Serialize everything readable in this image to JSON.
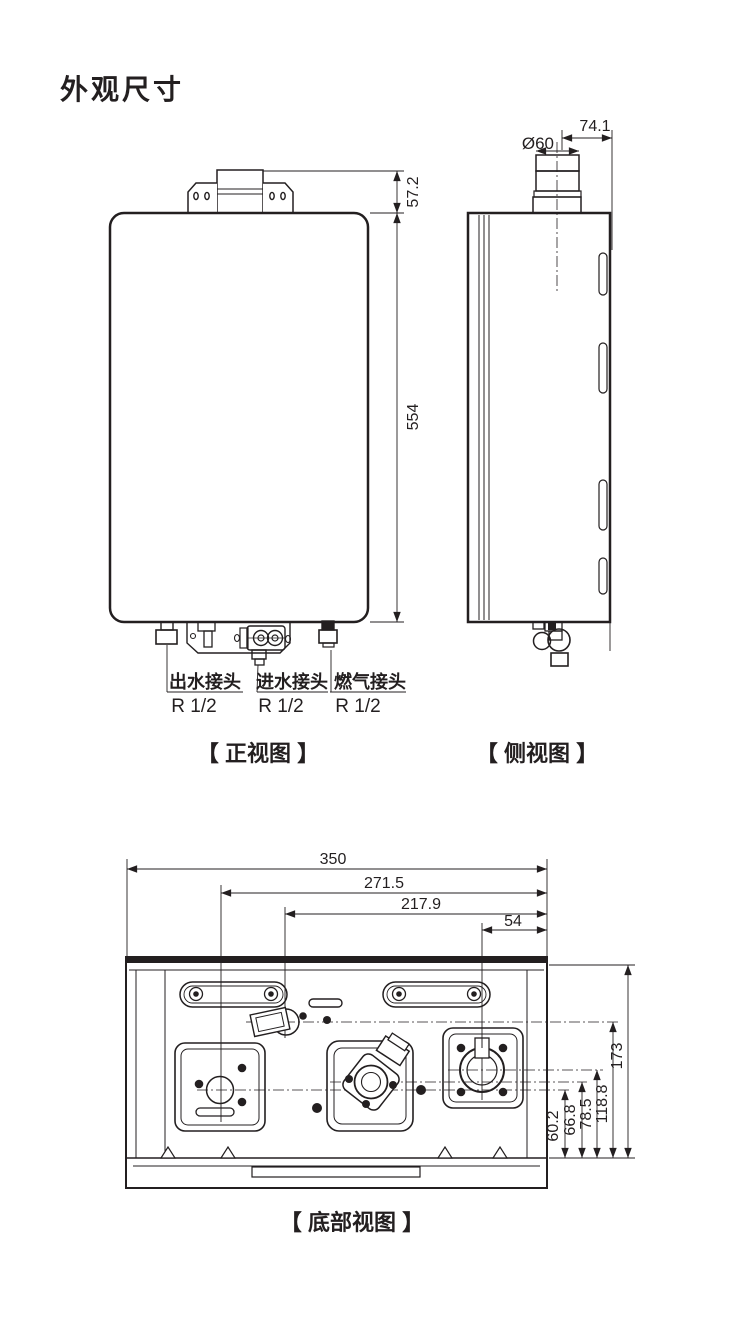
{
  "title": "外观尺寸",
  "colors": {
    "line": "#231f20",
    "background": "#ffffff"
  },
  "front_view": {
    "caption": "【 正视图 】",
    "dim_bracket_height": "57.2",
    "dim_body_height": "554",
    "connections": [
      {
        "label": "出水接头",
        "size": "R 1/2"
      },
      {
        "label": "进水接头",
        "size": "R 1/2"
      },
      {
        "label": "燃气接头",
        "size": "R 1/2"
      }
    ]
  },
  "side_view": {
    "caption": "【 侧视图 】",
    "dim_flue_diameter": "Ø60",
    "dim_flue_offset": "74.1"
  },
  "bottom_view": {
    "caption": "【 底部视图 】",
    "dims_horizontal": [
      "350",
      "271.5",
      "217.9",
      "54"
    ],
    "dims_vertical": [
      "60.2",
      "66.8",
      "78.5",
      "118.8",
      "173"
    ]
  }
}
